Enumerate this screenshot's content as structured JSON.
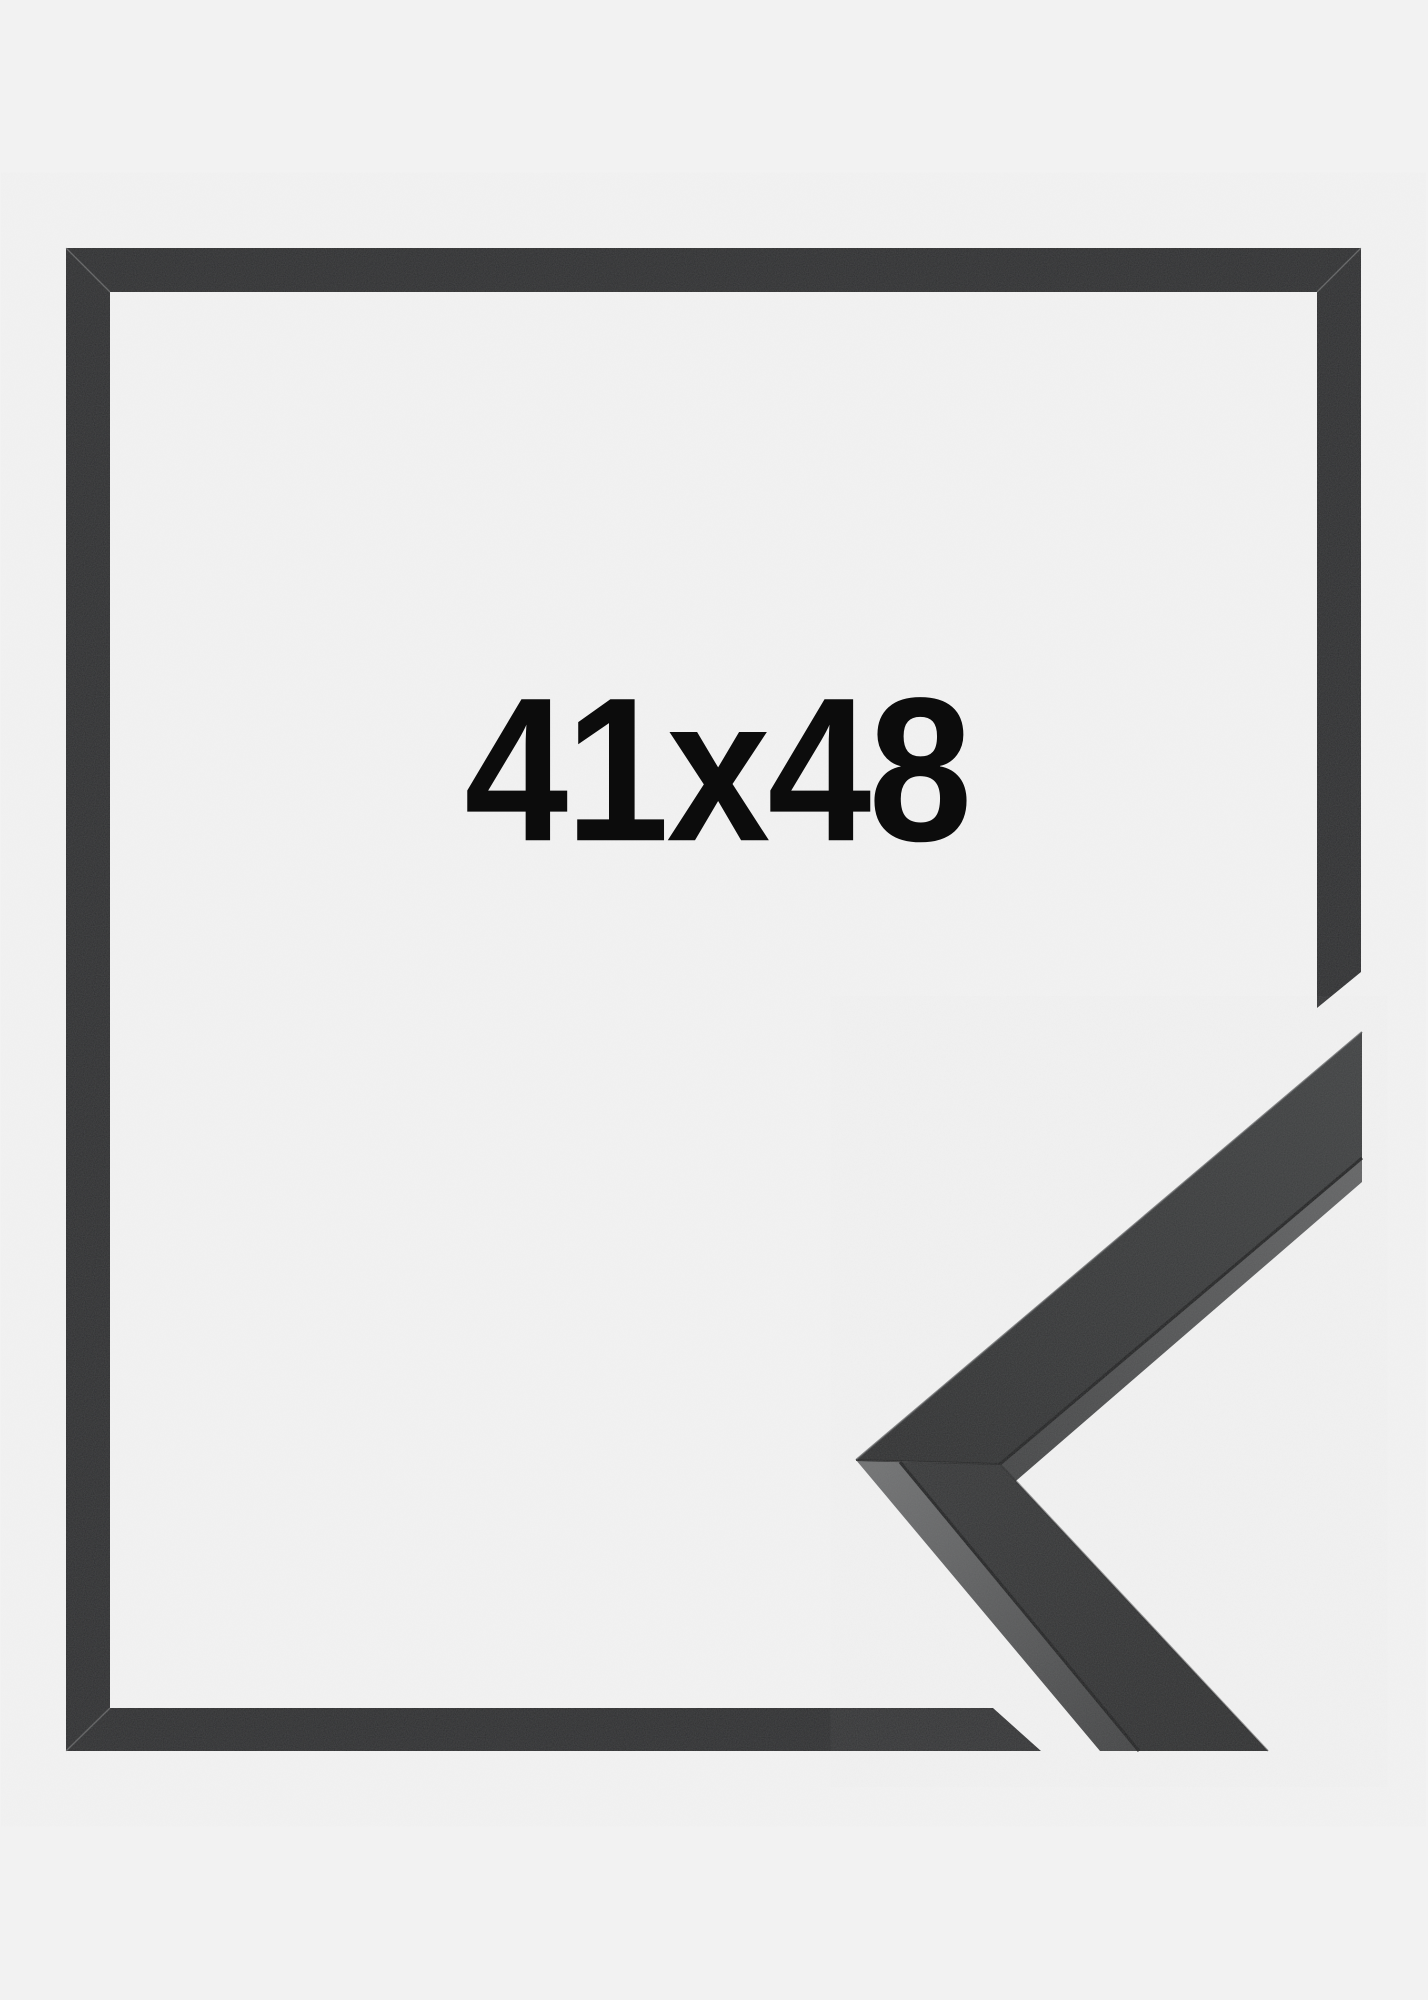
{
  "page": {
    "background_color": "#f2f2f2"
  },
  "size_label": {
    "text": "41x48",
    "color": "#0c0c0c"
  },
  "frame": {
    "bar_color": "#2b2c2e",
    "corner_sample": {
      "face_dark": "#2c2d2e",
      "face_light": "#3e4041",
      "face_lower_top": "#343536",
      "face_lower_bottom": "#2c2d2e",
      "side_light": "#707172",
      "side_mid": "#636465",
      "side_dark": "#434445",
      "seam_color": "#1a1b1c",
      "edge_highlight": "#4a4c4e"
    }
  }
}
